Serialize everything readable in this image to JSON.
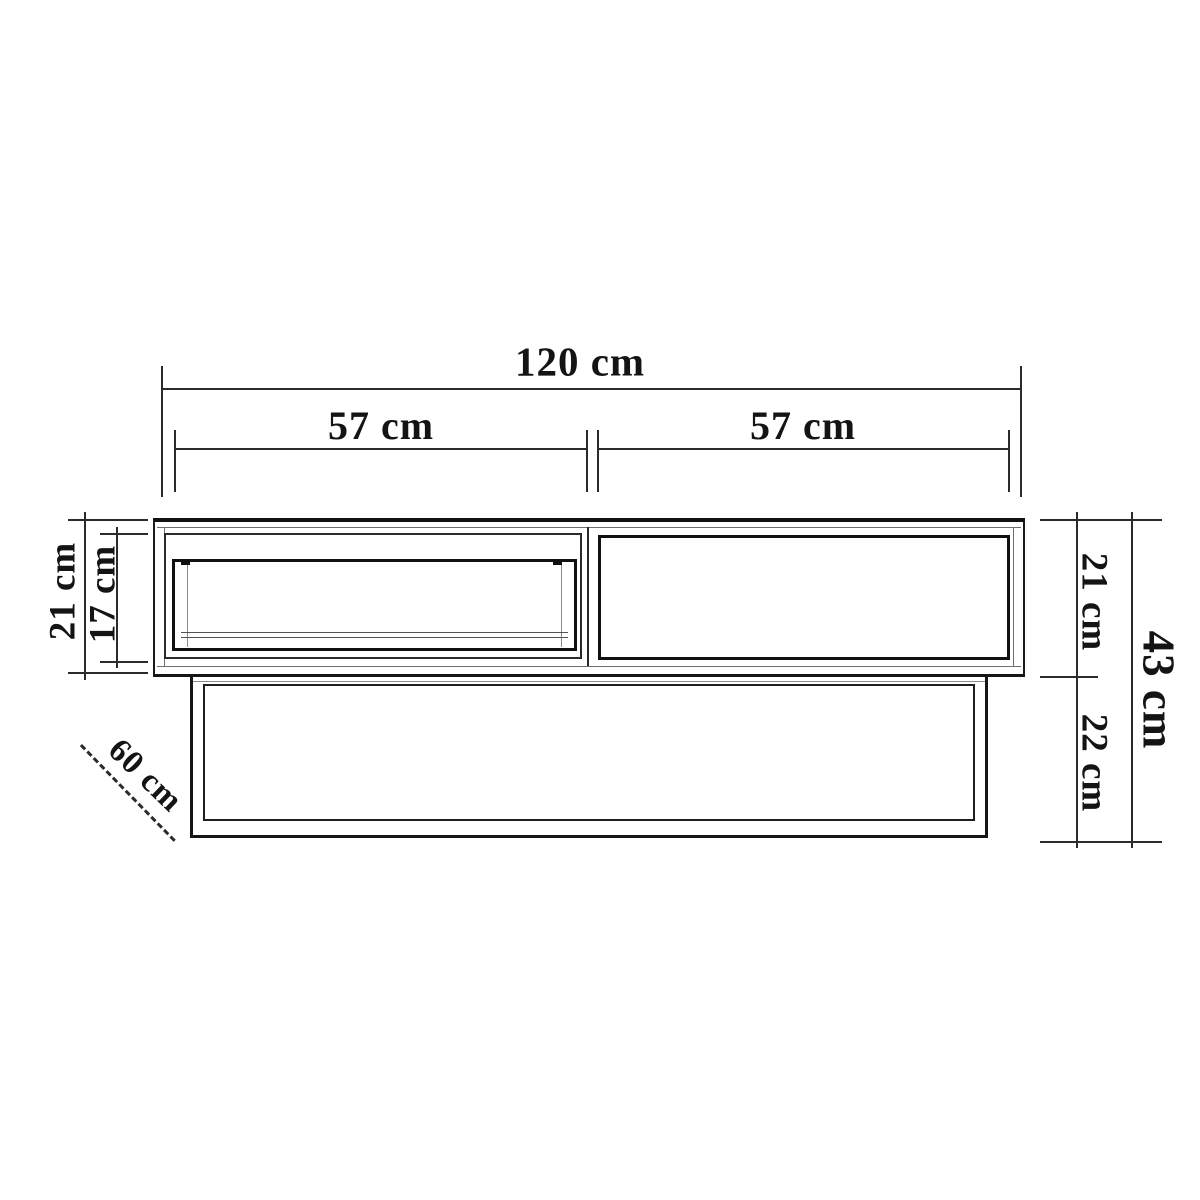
{
  "diagram": {
    "kind": "furniture-dimension-drawing",
    "view": "front-elevation",
    "ink_color": "#1a1a1a",
    "background_color": "#ffffff"
  },
  "labels": {
    "total_width": "120 cm",
    "left_section_width": "57 cm",
    "right_section_width": "57 cm",
    "left_unit_height": "21 cm",
    "drawer_opening_height": "17 cm",
    "right_top_height": "21 cm",
    "base_height": "22 cm",
    "total_height": "43 cm",
    "depth": "60 cm"
  }
}
